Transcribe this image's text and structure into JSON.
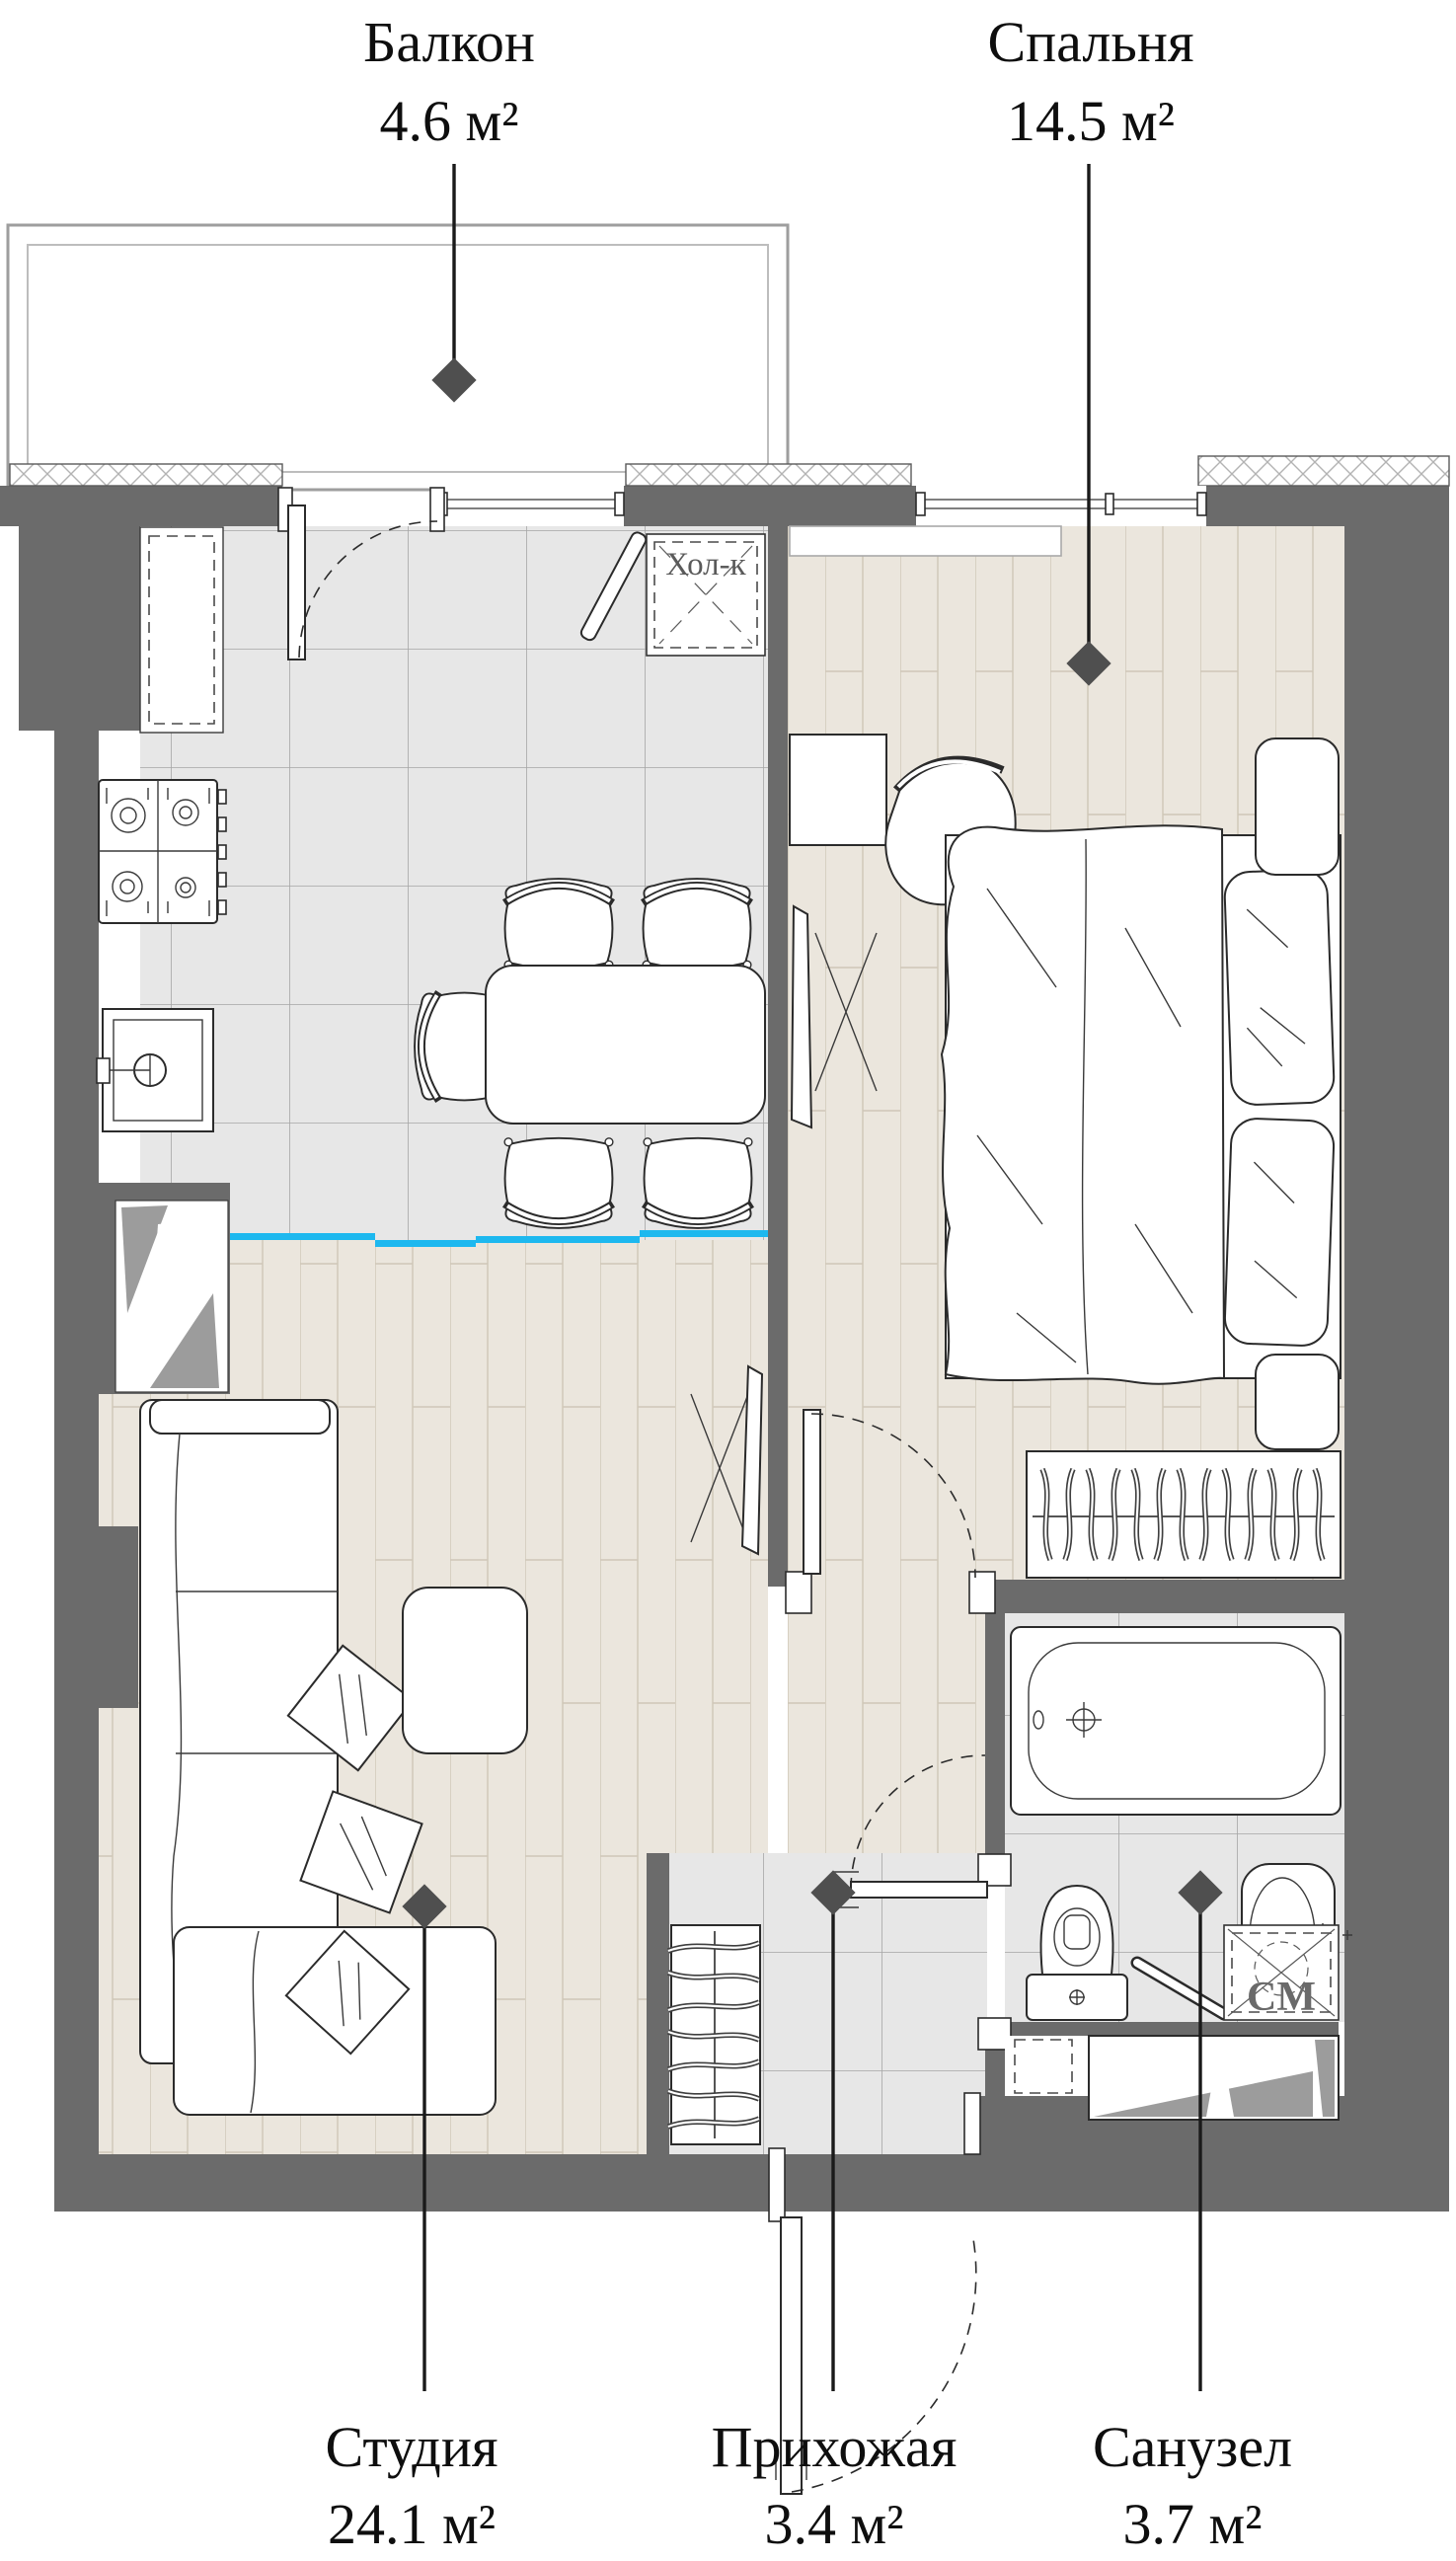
{
  "plan": {
    "type": "apartment-floor-plan",
    "rooms": [
      {
        "id": "balcony",
        "name": "Балкон",
        "area": "4.6 м²"
      },
      {
        "id": "bedroom",
        "name": "Спальня",
        "area": "14.5 м²"
      },
      {
        "id": "studio",
        "name": "Студия",
        "area": "24.1 м²"
      },
      {
        "id": "hallway",
        "name": "Прихожая",
        "area": "3.4 м²"
      },
      {
        "id": "bathroom",
        "name": "Санузел",
        "area": "3.7 м²"
      }
    ],
    "annotations": {
      "fridge": "Хол-к",
      "washing_machine": "СМ"
    },
    "colors": {
      "wall": "#6b6b6b",
      "accent": "#1db8ef",
      "marker": "#4f4f4f",
      "tile": "#e7e7e7",
      "plank": "#ebe6dd"
    }
  }
}
